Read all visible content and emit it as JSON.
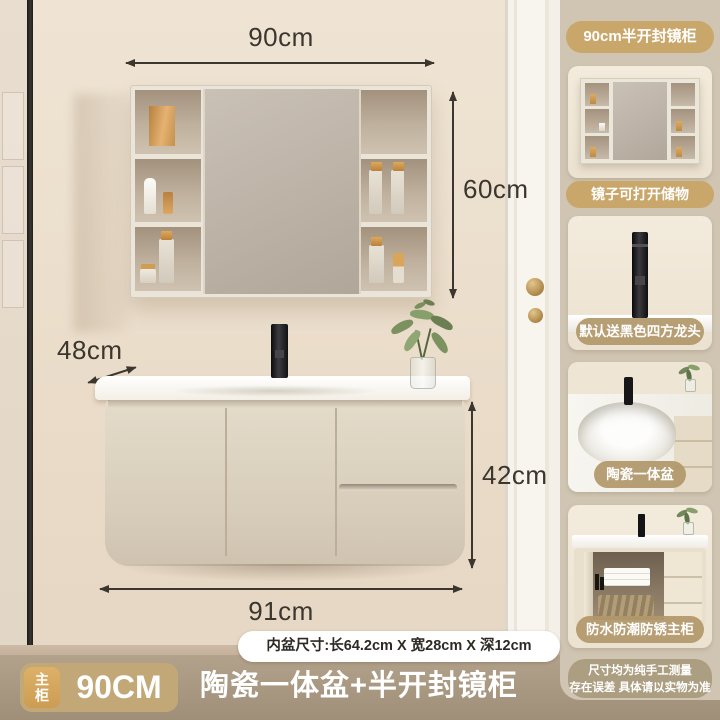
{
  "scene": {
    "dims": {
      "top": "90cm",
      "mirror": "60cm",
      "depth": "48cm",
      "height": "42cm",
      "bottom": "91cm"
    },
    "basin_note": "内盆尺寸:长64.2cm X 宽28cm X 深12cm"
  },
  "sidebar": {
    "labels": {
      "mirror_cabinet": "90cm半开封镜柜",
      "mirror_storage": "镜子可打开储物",
      "faucet": "默认送黑色四方龙头",
      "basin": "陶瓷一体盆",
      "main_cabinet": "防水防潮防锈主柜"
    },
    "disclaimer": {
      "line1": "尺寸均为纯手工测量",
      "line2": "存在误差 具体请以实物为准"
    }
  },
  "footer": {
    "badge": "主柜",
    "size": "90CM",
    "title": "陶瓷一体盆+半开封镜柜"
  },
  "colors": {
    "accent_gold": "#c9a66a",
    "sidebar_bg": "#cfc5b2",
    "footer_bg": "#a99878",
    "dim_text": "#3b362e"
  }
}
